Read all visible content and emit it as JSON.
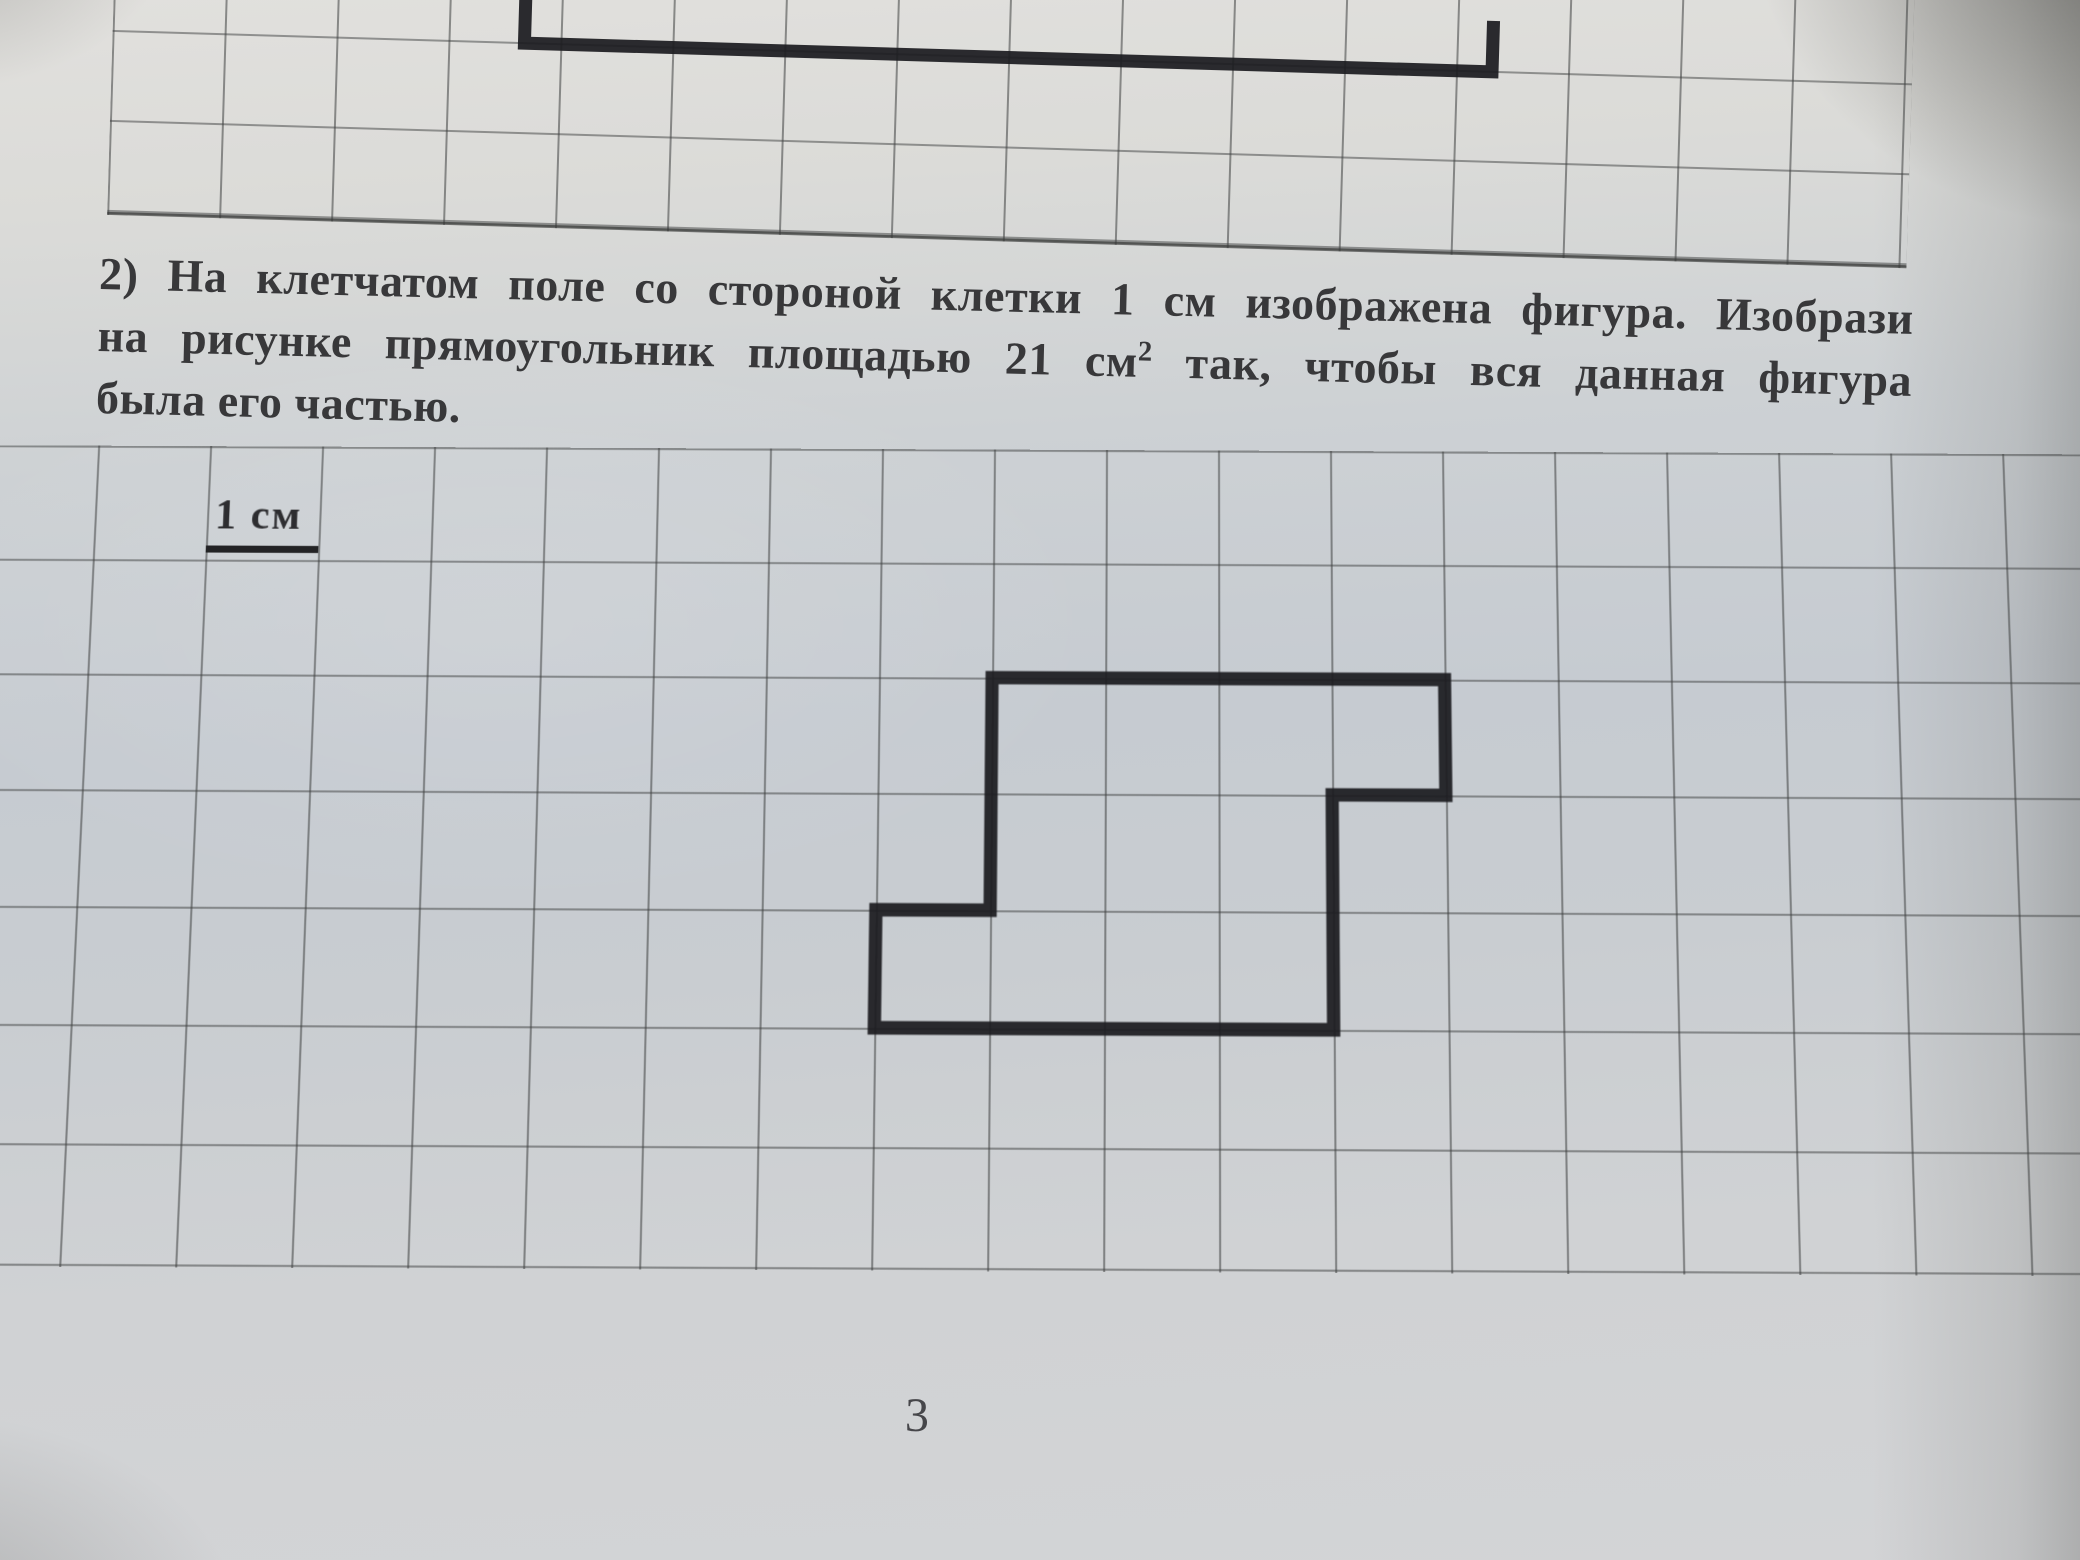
{
  "problem": {
    "line1": "2) На клетчатом поле со стороной клетки 1 см изображена фигура. Изобрази",
    "line2_before_sup": "на рисунке прямоугольник площадью 21 см",
    "line2_sup": "2",
    "line2_after_sup": " так, чтобы вся данная фигура",
    "line3": "была его частью."
  },
  "main_grid": {
    "scale_label": "1 см",
    "figure_points": "1008,226 1456,226 1456,339 1344,339 1344,565 896,565 896,452 1008,452"
  },
  "top_grid": {
    "figure_points": "412,130 412,181 1380,181 1380,130"
  },
  "page_number": "3",
  "colors": {
    "figure_stroke": "#1c1c20",
    "grid_line": "#3e4040",
    "text": "#38383a",
    "paper_mid": "#c6cbd1",
    "paper_top": "#e1e0dd"
  }
}
